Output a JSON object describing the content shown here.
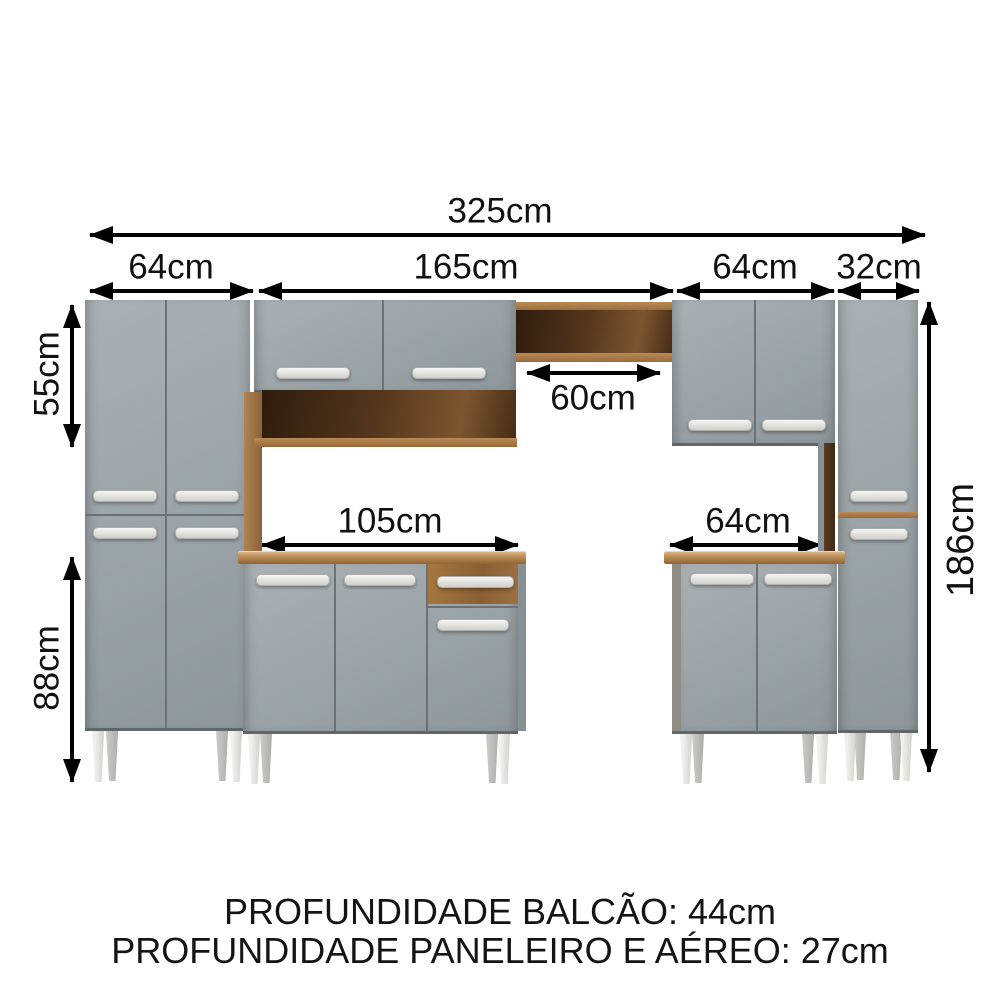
{
  "diagram": {
    "title_context": "kitchen cabinet set dimension diagram",
    "dimensions": {
      "total_width": "325cm",
      "left_section_width": "64cm",
      "center_section_width": "165cm",
      "right_section_width": "64cm",
      "tall_cabinet_width": "32cm",
      "upper_cabinet_height": "55cm",
      "lower_cabinet_height": "88cm",
      "niche_width": "60cm",
      "counter_width": "105cm",
      "right_base_width": "64cm",
      "total_height": "186cm"
    },
    "footer": {
      "line1": "PROFUNDIDADE BALCÃO: 44cm",
      "line2": "PROFUNDIDADE PANELEIRO E AÉREO: 27cm"
    },
    "colors": {
      "cabinet_grey": "#9aa3a7",
      "wood_light": "#b08354",
      "wood_dark_interior": "#4a2f18",
      "handle_silver": "#e9e9e7",
      "leg_white": "#e4e4e0",
      "annotation": "#111111",
      "background": "#ffffff"
    }
  }
}
